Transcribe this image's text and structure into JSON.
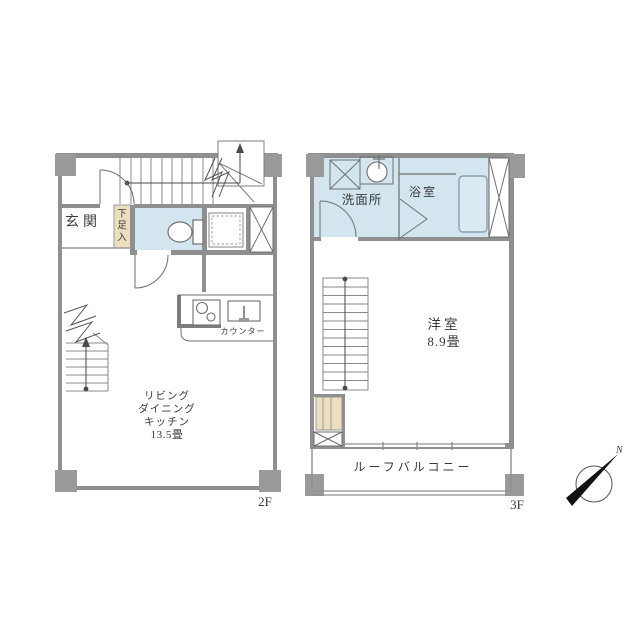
{
  "floor2": {
    "floor_label": "2F",
    "entrance_label": "玄関",
    "shoe_storage_label": "下足入",
    "counter_label": "カウンター",
    "ldk_label_lines": [
      "リビング",
      "ダイニング",
      "キッチン"
    ],
    "ldk_size_label": "13.5畳"
  },
  "floor3": {
    "floor_label": "3F",
    "washroom_label": "洗面所",
    "bathroom_label": "浴室",
    "room_label": "洋室",
    "room_size_label": "8.9畳",
    "balcony_label": "ルーフバルコニー"
  },
  "compass": {
    "north_label": "N"
  },
  "colors": {
    "wall_gray": "#8f8f8f",
    "pillar_gray": "#9a9a9a",
    "wet_area_blue": "#d3e6ef",
    "storage_tan": "#ecdfbe",
    "line_gray": "#6f6f6f",
    "text_color": "#3a3a3a",
    "background": "#ffffff"
  }
}
